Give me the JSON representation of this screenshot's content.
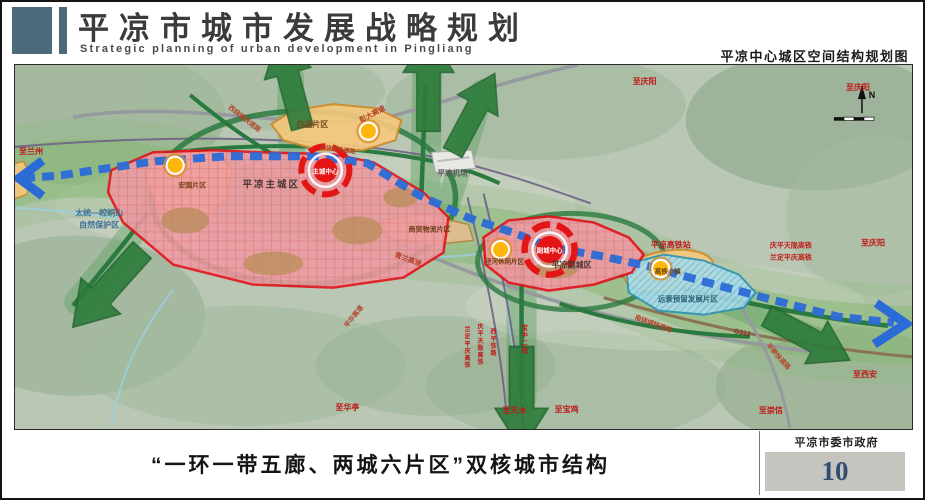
{
  "header": {
    "title": "平凉市城市发展战略规划",
    "subtitle": "Strategic planning of urban development in Pingliang",
    "map_title": "平凉中心城区空间结构规划图"
  },
  "footer": {
    "caption": "“一环一带五廊、两城六片区”双核城市结构",
    "agency": "平凉市委市政府",
    "page_number": "10"
  },
  "map": {
    "colors": {
      "header_accent": "#4d6a7d",
      "terrain_base": "#bac7b5",
      "eco_belt_green": "#85b871",
      "corridor_arrow_green": "#2e7d3c",
      "ring_road_green": "#2a7a40",
      "axis_blue": "#2b6bd6",
      "urban_zone_pink": "#f09aa2",
      "zone_border_red": "#e3101a",
      "core_red": "#e31515",
      "district_orange": "#f6c97c",
      "district_orange_border": "#cf8a2a",
      "reserved_cyan": "#a8dcea",
      "node_yellow": "#ffb60a",
      "label_red": "#c01818",
      "pagenum_blue": "#2f4f70"
    },
    "labels": [
      {
        "text": "平凉主城区",
        "x": 256,
        "y": 122,
        "size": 9.5,
        "color": "#4a3434",
        "ls": 2
      },
      {
        "text": "主城中心",
        "x": 310,
        "y": 108,
        "size": 6.5,
        "color": "#ffffff"
      },
      {
        "text": "平凉副城区",
        "x": 556,
        "y": 202,
        "size": 8,
        "color": "#4a3434"
      },
      {
        "text": "副城中心",
        "x": 534,
        "y": 187,
        "size": 6.5,
        "color": "#ffffff"
      },
      {
        "text": "白庙片区",
        "x": 297,
        "y": 62,
        "size": 8,
        "color": "#7a4418"
      },
      {
        "text": "安国片区",
        "x": 177,
        "y": 122,
        "size": 7,
        "color": "#7a4418"
      },
      {
        "text": "商贸物流片区",
        "x": 414,
        "y": 166,
        "size": 7,
        "color": "#6b3d14"
      },
      {
        "text": "泾河休闲片区",
        "x": 489,
        "y": 198,
        "size": 6.5,
        "color": "#6b3d14"
      },
      {
        "text": "远景预留发展片区",
        "x": 672,
        "y": 236,
        "size": 7.5,
        "color": "#2b6475"
      },
      {
        "text": "高铁小镇",
        "x": 652,
        "y": 208,
        "size": 6.5,
        "color": "#6b3d14"
      },
      {
        "text": "平凉高铁站",
        "x": 655,
        "y": 182,
        "size": 8,
        "color": "#c01818"
      },
      {
        "text": "平凉机场",
        "x": 437,
        "y": 110,
        "size": 7.5,
        "color": "#5a5a5a"
      },
      {
        "text": "太统—崆峒山",
        "x": 84,
        "y": 150,
        "size": 8,
        "color": "#3c6f93"
      },
      {
        "text": "自然保护区",
        "x": 84,
        "y": 162,
        "size": 8,
        "color": "#3c6f93"
      },
      {
        "text": "至兰州",
        "x": 16,
        "y": 89,
        "size": 8,
        "color": "#c01818"
      },
      {
        "text": "至庆阳",
        "x": 629,
        "y": 19,
        "size": 8,
        "color": "#c01818"
      },
      {
        "text": "至庆阳",
        "x": 842,
        "y": 25,
        "size": 8,
        "color": "#c01818"
      },
      {
        "text": "至庆阳",
        "x": 857,
        "y": 180,
        "size": 8,
        "color": "#c01818"
      },
      {
        "text": "至西安",
        "x": 849,
        "y": 311,
        "size": 8,
        "color": "#c01818"
      },
      {
        "text": "至崇信",
        "x": 755,
        "y": 347,
        "size": 8,
        "color": "#c01818"
      },
      {
        "text": "至宝鸡",
        "x": 551,
        "y": 346,
        "size": 8,
        "color": "#c01818"
      },
      {
        "text": "至天水",
        "x": 499,
        "y": 347,
        "size": 8,
        "color": "#c01818"
      },
      {
        "text": "至华亭",
        "x": 332,
        "y": 344,
        "size": 8,
        "color": "#c01818"
      },
      {
        "text": "彭大高速",
        "x": 358,
        "y": 51,
        "size": 7,
        "color": "#b3422a",
        "rot": -28
      },
      {
        "text": "西绕城快速路",
        "x": 228,
        "y": 55,
        "size": 6.5,
        "color": "#b3422a",
        "rot": 38
      },
      {
        "text": "北绕城快速路",
        "x": 322,
        "y": 86,
        "size": 6,
        "color": "#b3422a",
        "rot": 8
      },
      {
        "text": "青兰高速",
        "x": 392,
        "y": 196,
        "size": 7,
        "color": "#b3422a",
        "rot": 20
      },
      {
        "text": "南绕城快速路",
        "x": 637,
        "y": 260,
        "size": 6.5,
        "color": "#b3422a",
        "rot": 20
      },
      {
        "text": "G312",
        "x": 726,
        "y": 269,
        "size": 7,
        "color": "#8a2a2a",
        "rot": 12
      },
      {
        "text": "平崇快速路",
        "x": 761,
        "y": 292,
        "size": 6.5,
        "color": "#b3422a",
        "rot": 48
      },
      {
        "text": "庆平天陇高铁",
        "x": 775,
        "y": 182,
        "size": 7,
        "color": "#c01818"
      },
      {
        "text": "兰定平庆高铁",
        "x": 775,
        "y": 194,
        "size": 7,
        "color": "#c01818"
      },
      {
        "text": "兰定平庆高铁",
        "x": 452,
        "y": 266,
        "size": 6,
        "color": "#c01818",
        "vertical": true
      },
      {
        "text": "庆平天陇高铁",
        "x": 465,
        "y": 263,
        "size": 6,
        "color": "#c01818",
        "vertical": true
      },
      {
        "text": "西平铁路",
        "x": 478,
        "y": 268,
        "size": 6,
        "color": "#c01818",
        "vertical": true
      },
      {
        "text": "宝中二线",
        "x": 509,
        "y": 264,
        "size": 6.5,
        "color": "#c01818",
        "vertical": true
      },
      {
        "text": "平华高速",
        "x": 340,
        "y": 252,
        "size": 6.5,
        "color": "#b3422a",
        "rot": -52
      },
      {
        "text": "N",
        "x": 856,
        "y": 33,
        "size": 9,
        "color": "#111111"
      }
    ]
  }
}
